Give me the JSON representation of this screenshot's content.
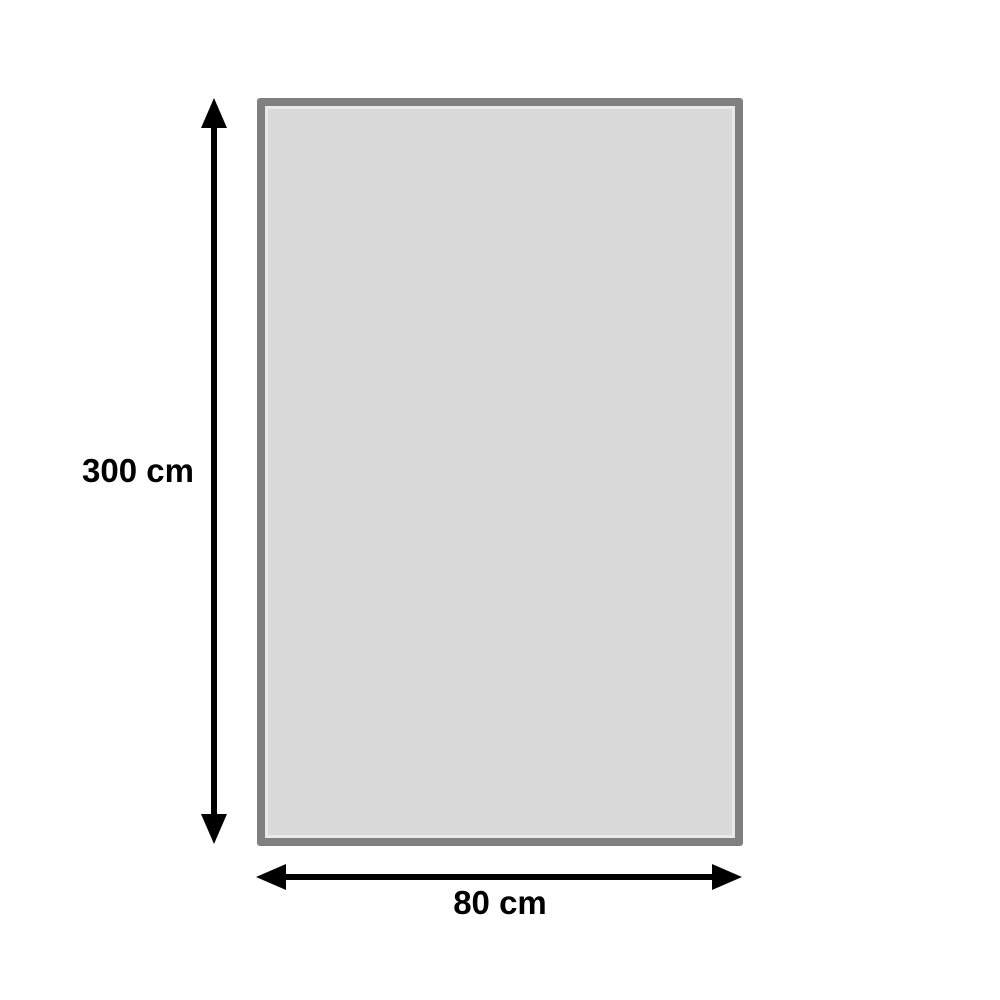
{
  "diagram": {
    "type": "dimension-diagram",
    "dimensions": {
      "height": {
        "label": "300 cm"
      },
      "width": {
        "label": "80 cm"
      }
    },
    "colors": {
      "background": "#ffffff",
      "rect_fill": "#d9d9d9",
      "rect_border": "#808080",
      "rect_inner_highlight": "#e9e9e9",
      "arrow": "#000000",
      "label_text": "#000000"
    }
  }
}
